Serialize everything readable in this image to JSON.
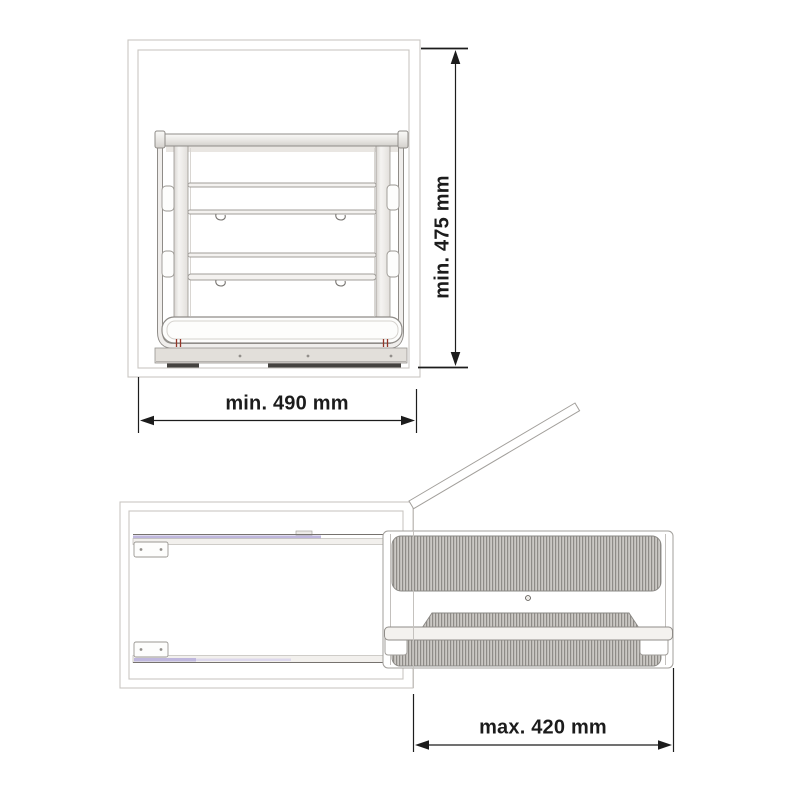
{
  "dimensions": {
    "cabinet_height": "min. 475 mm",
    "cabinet_width": "min. 490 mm",
    "extension": "max. 420 mm"
  },
  "colors": {
    "background": "#ffffff",
    "dim_line": "#1c1c1c",
    "cabinet_line": "#c9c6c2",
    "part_line": "#8f8c88",
    "hatch_dark": "#8e8b87",
    "hatch_light": "#cbc8c4",
    "rail_accent": "#bfb7dd",
    "pin_accent": "#943527",
    "base_fill": "#e2dfda",
    "foot_dark": "#44423f"
  }
}
